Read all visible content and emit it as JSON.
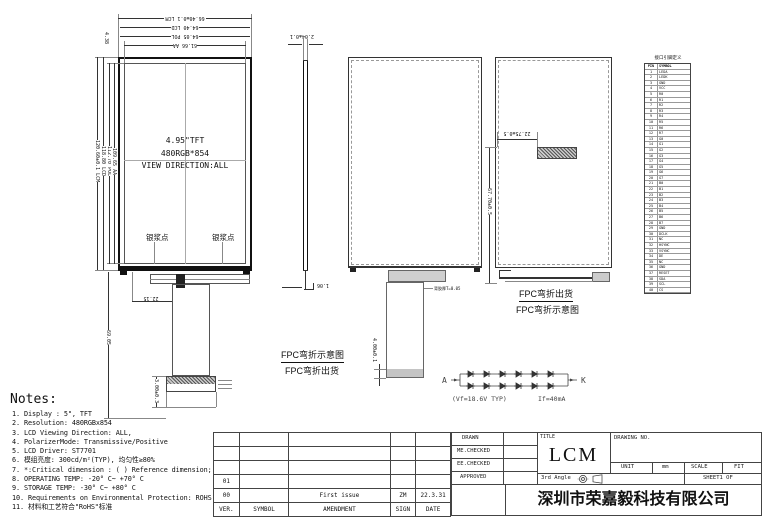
{
  "colors": {
    "line": "#333333",
    "fill_gray": "#cfcfcf",
    "black": "#111111"
  },
  "views": {
    "front": {
      "title_lines": [
        "4.95\"TFT",
        "480RGB*854",
        "VIEW DIRECTION:ALL"
      ],
      "silver_dot_left": "银浆点",
      "silver_dot_right": "银浆点",
      "dims_top": [
        "66.40±0.1 LCM",
        "64.40 LCD",
        "64.05 POL",
        "61.66 AA"
      ],
      "dims_left": [
        "120.60±0.1 LCM",
        "118.80 LCD",
        "112.70 POL",
        "109.65 AA"
      ],
      "dim_top_border": "4.38",
      "dim_fpc_offset": "22.15",
      "dim_total_height": "69.05",
      "dim_connector": "3.00±0.3"
    },
    "side": {
      "dim_thickness": "2.04±0.1",
      "dim_bottom": "1.06"
    },
    "back_unfolded": {
      "dim_stiffener": "4.00±0.1",
      "callout": "背胶厚T=0.05",
      "label_line1": "FPC弯折示意图",
      "label_line2": "FPC弯折出货"
    },
    "back_folded": {
      "dim_fpc_x": "22.75±0.5",
      "dim_fpc_y": "67.70±0.5",
      "label_line1": "FPC弯折出货",
      "label_line2": "FPC弯折示意图"
    }
  },
  "backlight": {
    "anode": "A",
    "cathode": "K",
    "spec_vf": "(Vf=18.6V TYP)",
    "spec_if": "If=40mA"
  },
  "pin_table": {
    "title": "接口引脚定义",
    "headers": [
      "PIN",
      "SYMBOL"
    ],
    "rows": [
      {
        "pin": "1",
        "symbol": "LEDA"
      },
      {
        "pin": "2",
        "symbol": "LEDK"
      },
      {
        "pin": "3",
        "symbol": "GND"
      },
      {
        "pin": "4",
        "symbol": "VCC"
      },
      {
        "pin": "5",
        "symbol": "R0"
      },
      {
        "pin": "6",
        "symbol": "R1"
      },
      {
        "pin": "7",
        "symbol": "R2"
      },
      {
        "pin": "8",
        "symbol": "R3"
      },
      {
        "pin": "9",
        "symbol": "R4"
      },
      {
        "pin": "10",
        "symbol": "R5"
      },
      {
        "pin": "11",
        "symbol": "R6"
      },
      {
        "pin": "12",
        "symbol": "R7"
      },
      {
        "pin": "13",
        "symbol": "G0"
      },
      {
        "pin": "14",
        "symbol": "G1"
      },
      {
        "pin": "15",
        "symbol": "G2"
      },
      {
        "pin": "16",
        "symbol": "G3"
      },
      {
        "pin": "17",
        "symbol": "G4"
      },
      {
        "pin": "18",
        "symbol": "G5"
      },
      {
        "pin": "19",
        "symbol": "G6"
      },
      {
        "pin": "20",
        "symbol": "G7"
      },
      {
        "pin": "21",
        "symbol": "B0"
      },
      {
        "pin": "22",
        "symbol": "B1"
      },
      {
        "pin": "23",
        "symbol": "B2"
      },
      {
        "pin": "24",
        "symbol": "B3"
      },
      {
        "pin": "25",
        "symbol": "B4"
      },
      {
        "pin": "26",
        "symbol": "B5"
      },
      {
        "pin": "27",
        "symbol": "B6"
      },
      {
        "pin": "28",
        "symbol": "B7"
      },
      {
        "pin": "29",
        "symbol": "GND"
      },
      {
        "pin": "30",
        "symbol": "DCLK"
      },
      {
        "pin": "31",
        "symbol": "NC"
      },
      {
        "pin": "32",
        "symbol": "HSYNC"
      },
      {
        "pin": "33",
        "symbol": "VSYNC"
      },
      {
        "pin": "34",
        "symbol": "DE"
      },
      {
        "pin": "35",
        "symbol": "NC"
      },
      {
        "pin": "36",
        "symbol": "GND"
      },
      {
        "pin": "37",
        "symbol": "RESET"
      },
      {
        "pin": "38",
        "symbol": "SDA"
      },
      {
        "pin": "39",
        "symbol": "SCL"
      },
      {
        "pin": "40",
        "symbol": "CS"
      }
    ]
  },
  "notes": {
    "heading": "Notes:",
    "items": [
      "1.  Display : 5\",  TFT",
      "2.  Resolution: 480RGBx854",
      "3.  LCD Viewing Direction: ALL,",
      "4.  PolarizerMode: Transmissive/Positive",
      "5.  LCD Driver: ST7701",
      "6.  模组亮度: 300cd/m²(TYP), 均匀性≥80%",
      "7.  *:Critical dimension : ( ) Reference dimension;",
      "8.  OPERATING TEMP: -20° C~ +70° C",
      "9.  STORAGE TEMP: -30° C~ +80° C",
      "10. Requirements on Environmental Protection: ROHS",
      "11. 材料和工艺符合\"RoHS\"标准"
    ]
  },
  "revision_table": {
    "rows": [
      [
        "",
        "",
        "",
        "",
        ""
      ],
      [
        "",
        "",
        "",
        "",
        ""
      ],
      [
        "",
        "",
        "",
        "",
        ""
      ],
      [
        "01",
        "",
        "",
        "",
        ""
      ],
      [
        "00",
        "",
        "First issue",
        "ZM",
        "22.3.31"
      ],
      [
        "VER.",
        "SYMBOL",
        "AMENDMENT",
        "SIGN",
        "DATE"
      ]
    ]
  },
  "title_block": {
    "sign_rows": [
      "DRAWN",
      "ME.CHECKED",
      "EE.CHECKED",
      "APPROVED"
    ],
    "title_label": "TITLE",
    "title": "LCM",
    "drawing_no_label": "DRAWING NO.",
    "unit_label": "UNIT",
    "unit_value": "mm",
    "scale_label": "SCALE",
    "fit_label": "FIT",
    "angle_label": "3rd Angle",
    "sheet_label": "SHEET1  OF",
    "company": "深圳市荣嘉毅科技有限公司"
  }
}
